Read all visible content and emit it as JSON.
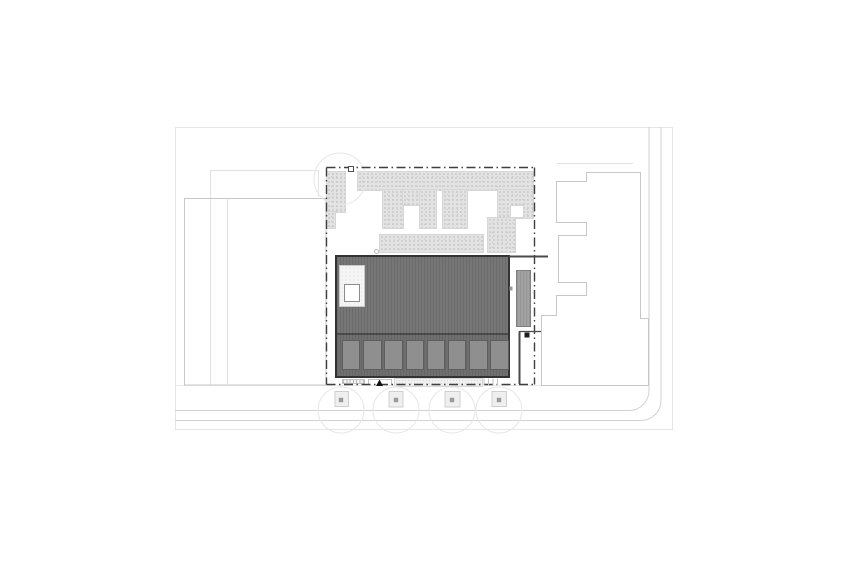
{
  "plan": {
    "description": "architectural site roof plan, no text labels visible",
    "colors": {
      "paper": "#ffffff",
      "boundary": "#e6e6e6",
      "faint": "#e2e2e2",
      "pavement": "#e9e9e9",
      "street": "#d2d2d2",
      "neighbor": "#c7c7c7",
      "property": "#3f3f3f",
      "wall": "#4a4a4a",
      "roof_fill": "#767676",
      "roof_stripe": "#6b6b6b",
      "roof_outline": "#333333",
      "band_fill": "#6f6f6f",
      "band_stripe": "#666666",
      "panel_fill": "#8f8f8f",
      "panel_edge": "#5e5e5e",
      "terrace_fill": "#f5f5f5",
      "terrace_dot": "#dcdcdc",
      "terrace_edge": "#c9c9c9",
      "skylight_edge": "#8d8d8d",
      "strip_fill": "#a2a2a2",
      "strip_stripe": "#969696",
      "strip_edge": "#808080",
      "stipple_bg": "#e3e3e3",
      "stipple_dot": "#c9c9c9",
      "stipple_edge": "#d6d6d6",
      "paving_bg": "#f0f0f0",
      "paving_dot": "#d9d9d9",
      "steps_tick": "#bbbbbb",
      "light_edge": "#c2c2c2",
      "tree_ring": "#e7e7e7",
      "tree_pit_edge": "#cfcfcf",
      "tree_pit_fill": "#efefef",
      "tree_dot": "#9a9a9a",
      "marker": "#1e1e1e",
      "tick": "#c2c2c2",
      "garden_dot_ring": "#b9b9b9"
    },
    "roof_panels": {
      "count": 8,
      "x0": 342,
      "pitch": 21.2,
      "w": 18.4,
      "y": 340,
      "h": 30
    },
    "garden_patches": [
      [
        327,
        172,
        18,
        40
      ],
      [
        327,
        212,
        8,
        16
      ],
      [
        358,
        172,
        175,
        18
      ],
      [
        383,
        190,
        20,
        38
      ],
      [
        403,
        190,
        16,
        15
      ],
      [
        420,
        190,
        16,
        38
      ],
      [
        443,
        190,
        24,
        38
      ],
      [
        498,
        190,
        35,
        28
      ],
      [
        488,
        218,
        27,
        34
      ],
      [
        380,
        235,
        103,
        17
      ]
    ],
    "white_insets": [
      [
        511,
        206,
        12,
        11
      ]
    ],
    "trees": [
      {
        "cx": 341,
        "ring_cy": 410,
        "ring_r": 23,
        "pit": [
          335,
          391.5,
          13.5,
          15
        ]
      },
      {
        "cx": 396,
        "ring_cy": 410,
        "ring_r": 23,
        "pit": [
          389,
          391.5,
          14,
          15.5
        ]
      },
      {
        "cx": 452,
        "ring_cy": 410,
        "ring_r": 23,
        "pit": [
          445,
          391.5,
          15,
          15.5
        ]
      },
      {
        "cx": 499,
        "ring_cy": 410,
        "ring_r": 23,
        "pit": [
          492,
          391.5,
          14.5,
          15
        ]
      }
    ],
    "entrance_ticks": {
      "xs": [
        484,
        488.5,
        493,
        497.5
      ],
      "y1": 378.5,
      "y2": 385.5
    }
  }
}
